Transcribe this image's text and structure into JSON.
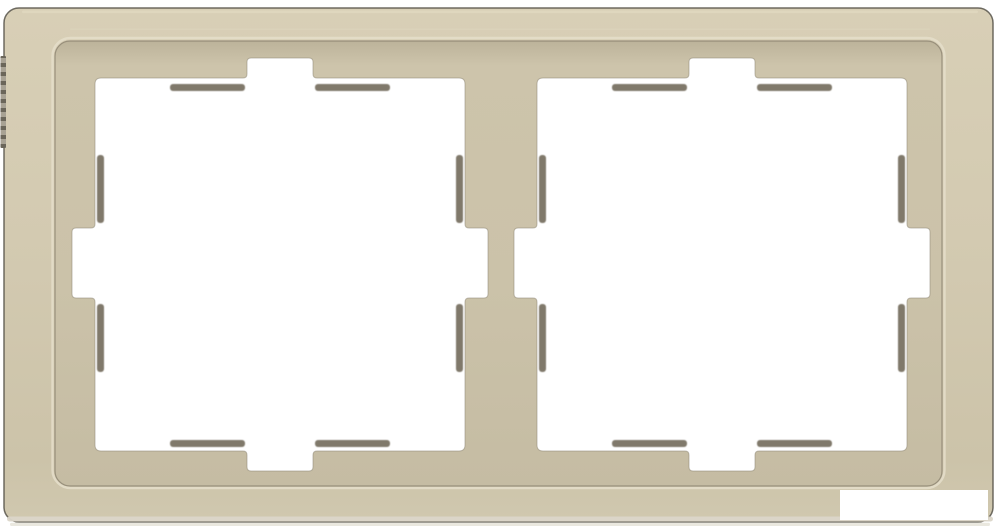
{
  "meta": {
    "description": "Product photo of a sahara beige double (2-gang) wall switch cover frame with two square notched cutouts on a white background"
  },
  "product": {
    "kind": "switch-cover-frame",
    "gangs": 2,
    "finish_color_name": "sahara beige"
  },
  "colors": {
    "background": "#FFFFFF",
    "white": "#FFFFFF",
    "faceTop": "#D8CFB6",
    "faceMid": "#D3CAB1",
    "faceLow": "#CCC3A9",
    "faceBottom": "#D0C8AF",
    "outerStroke": "#57534A",
    "topHighlight": "#E2DAC2",
    "bottomStrip": "#DBD6C9",
    "bottomEdge": "#E8E5DC",
    "halo": "#E5DECA",
    "contour": "#8C8370",
    "recessShadow": "#BCB39A",
    "recessHi": "#CDC4AB",
    "recessMid": "#CBC2A9",
    "recessBottom": "#C5BCA3",
    "ledge": "#6E6756",
    "cutoutStroke": "#8F8876",
    "knurlDark": "#6B665A",
    "knurlLight": "#A8A294"
  }
}
